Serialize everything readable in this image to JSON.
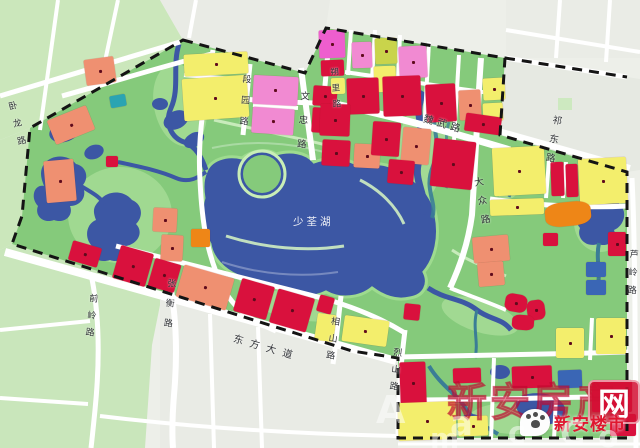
{
  "map": {
    "lake": {
      "name": "少荃湖"
    },
    "palette": {
      "red": "#d9113d",
      "salmon": "#ef9071",
      "yellow": "#f3ee6c",
      "pink": "#f18ad2",
      "magenta": "#ee5ece",
      "orange": "#ee8617",
      "olive": "#c9d44b",
      "teal": "#2aa4b2",
      "blue": "#3a66b5",
      "park_green": "#85ca7b",
      "marsh_green": "#a6dc97",
      "water": "#3c57a4",
      "stream_teal": "#3a7d96",
      "outside_green": "#cbe7bb",
      "city_gray": "#e9ebe5",
      "boundary": "#141414"
    },
    "road_labels": [
      {
        "id": "wolong",
        "name": "卧龙路",
        "x": 7,
        "y": 100,
        "rot": -14,
        "vertical": true,
        "s": 9,
        "gap": 5
      },
      {
        "id": "qianling",
        "name": "前岭路",
        "x": 90,
        "y": 291,
        "rot": 6,
        "vertical": true,
        "s": 9,
        "gap": 4
      },
      {
        "id": "zhangheng",
        "name": "张衡路",
        "x": 168,
        "y": 276,
        "rot": 5,
        "vertical": true,
        "s": 9,
        "gap": 7
      },
      {
        "id": "dongfangdadao",
        "name": "东方大道",
        "x": 236,
        "y": 330,
        "rot": 16,
        "vertical": false,
        "s": 10,
        "gap": 7
      },
      {
        "id": "duanyuan",
        "name": "段园路",
        "x": 243,
        "y": 72,
        "rot": 4,
        "vertical": true,
        "s": 9,
        "gap": 8
      },
      {
        "id": "wenzhong",
        "name": "文忠路",
        "x": 301,
        "y": 88,
        "rot": 4,
        "vertical": true,
        "s": 9.5,
        "gap": 10
      },
      {
        "id": "shuoli",
        "name": "朔里路",
        "x": 330,
        "y": 66,
        "rot": -4,
        "vertical": true,
        "s": 8.5,
        "gap": 4
      },
      {
        "id": "weiwu",
        "name": "魏武路",
        "x": 426,
        "y": 110,
        "rot": 16,
        "vertical": false,
        "s": 10,
        "gap": 4
      },
      {
        "id": "dazhong",
        "name": "大众路",
        "x": 473,
        "y": 175,
        "rot": -10,
        "vertical": true,
        "s": 9.5,
        "gap": 5
      },
      {
        "id": "qidong",
        "name": "祁东路",
        "x": 554,
        "y": 112,
        "rot": 10,
        "vertical": true,
        "s": 9.5,
        "gap": 5
      },
      {
        "id": "xiangshan",
        "name": "相山路",
        "x": 332,
        "y": 314,
        "rot": 8,
        "vertical": true,
        "s": 9,
        "gap": 4
      },
      {
        "id": "lieshan",
        "name": "烈山路",
        "x": 394,
        "y": 345,
        "rot": 6,
        "vertical": true,
        "s": 9,
        "gap": 4
      },
      {
        "id": "luling",
        "name": "芦岭路",
        "x": 630,
        "y": 247,
        "rot": 3,
        "vertical": true,
        "s": 9,
        "gap": 5
      }
    ],
    "parcels": [
      {
        "x": 184,
        "y": 53,
        "w": 64,
        "h": 22,
        "c": "yellow",
        "r": -3,
        "d": 1
      },
      {
        "x": 183,
        "y": 77,
        "w": 65,
        "h": 42,
        "c": "yellow",
        "r": -4,
        "d": 1
      },
      {
        "x": 253,
        "y": 76,
        "w": 45,
        "h": 29,
        "c": "pink",
        "r": 3,
        "d": 1
      },
      {
        "x": 252,
        "y": 108,
        "w": 42,
        "h": 26,
        "c": "pink",
        "r": 4,
        "d": 1
      },
      {
        "x": 313,
        "y": 86,
        "w": 24,
        "h": 20,
        "c": "red",
        "r": 4,
        "d": 1
      },
      {
        "x": 312,
        "y": 108,
        "w": 26,
        "h": 25,
        "c": "red",
        "r": 4,
        "d": 1
      },
      {
        "x": 319,
        "y": 30,
        "w": 26,
        "h": 28,
        "c": "magenta",
        "r": -2,
        "d": 1
      },
      {
        "x": 321,
        "y": 60,
        "w": 23,
        "h": 16,
        "c": "red",
        "r": -2,
        "d": 0
      },
      {
        "x": 352,
        "y": 42,
        "w": 20,
        "h": 26,
        "c": "pink",
        "r": -2,
        "d": 1
      },
      {
        "x": 375,
        "y": 38,
        "w": 22,
        "h": 26,
        "c": "olive",
        "r": -2,
        "d": 1
      },
      {
        "x": 374,
        "y": 66,
        "w": 22,
        "h": 26,
        "c": "yellow",
        "r": -2,
        "d": 1
      },
      {
        "x": 399,
        "y": 46,
        "w": 28,
        "h": 32,
        "c": "pink",
        "r": -3,
        "d": 1
      },
      {
        "x": 331,
        "y": 78,
        "w": 14,
        "h": 16,
        "c": "yellow",
        "r": -2,
        "d": 0
      },
      {
        "x": 347,
        "y": 78,
        "w": 32,
        "h": 36,
        "c": "red",
        "r": -2,
        "d": 1
      },
      {
        "x": 383,
        "y": 76,
        "w": 38,
        "h": 40,
        "c": "red",
        "r": -2,
        "d": 1
      },
      {
        "x": 426,
        "y": 84,
        "w": 30,
        "h": 38,
        "c": "red",
        "r": -3,
        "d": 1
      },
      {
        "x": 459,
        "y": 90,
        "w": 22,
        "h": 30,
        "c": "salmon",
        "r": -3,
        "d": 1
      },
      {
        "x": 483,
        "y": 78,
        "w": 22,
        "h": 22,
        "c": "yellow",
        "r": -3,
        "d": 1
      },
      {
        "x": 483,
        "y": 103,
        "w": 20,
        "h": 18,
        "c": "yellow",
        "r": -3,
        "d": 0
      },
      {
        "x": 465,
        "y": 115,
        "w": 36,
        "h": 18,
        "c": "red",
        "r": 8,
        "d": 1
      },
      {
        "x": 320,
        "y": 104,
        "w": 30,
        "h": 32,
        "c": "red",
        "r": 2,
        "d": 1
      },
      {
        "x": 322,
        "y": 140,
        "w": 28,
        "h": 26,
        "c": "red",
        "r": 3,
        "d": 1
      },
      {
        "x": 354,
        "y": 144,
        "w": 26,
        "h": 24,
        "c": "salmon",
        "r": 3,
        "d": 1
      },
      {
        "x": 372,
        "y": 122,
        "w": 28,
        "h": 34,
        "c": "red",
        "r": 4,
        "d": 1
      },
      {
        "x": 402,
        "y": 128,
        "w": 28,
        "h": 36,
        "c": "salmon",
        "r": 5,
        "d": 1
      },
      {
        "x": 388,
        "y": 160,
        "w": 26,
        "h": 24,
        "c": "red",
        "r": 5,
        "d": 1
      },
      {
        "x": 432,
        "y": 140,
        "w": 42,
        "h": 48,
        "c": "red",
        "r": 6,
        "d": 1
      },
      {
        "x": 493,
        "y": 147,
        "w": 52,
        "h": 48,
        "c": "yellow",
        "r": -3,
        "d": 1
      },
      {
        "x": 551,
        "y": 162,
        "w": 13,
        "h": 34,
        "c": "red",
        "r": -2,
        "d": 0
      },
      {
        "x": 566,
        "y": 164,
        "w": 12,
        "h": 33,
        "c": "red",
        "r": -2,
        "d": 0
      },
      {
        "x": 579,
        "y": 158,
        "w": 48,
        "h": 46,
        "c": "yellow",
        "r": -3,
        "d": 1
      },
      {
        "x": 490,
        "y": 199,
        "w": 54,
        "h": 16,
        "c": "yellow",
        "r": -2,
        "d": 1
      },
      {
        "x": 545,
        "y": 202,
        "w": 46,
        "h": 24,
        "c": "orange",
        "r": -6,
        "d": 0,
        "rr": 1
      },
      {
        "x": 608,
        "y": 232,
        "w": 18,
        "h": 24,
        "c": "red",
        "r": 0,
        "d": 1
      },
      {
        "x": 586,
        "y": 262,
        "w": 20,
        "h": 15,
        "c": "blue",
        "r": 0,
        "d": 0
      },
      {
        "x": 586,
        "y": 280,
        "w": 20,
        "h": 15,
        "c": "blue",
        "r": 0,
        "d": 0
      },
      {
        "x": 596,
        "y": 318,
        "w": 30,
        "h": 36,
        "c": "yellow",
        "r": 0,
        "d": 1
      },
      {
        "x": 556,
        "y": 328,
        "w": 28,
        "h": 30,
        "c": "yellow",
        "r": 0,
        "d": 1
      },
      {
        "x": 85,
        "y": 58,
        "w": 30,
        "h": 26,
        "c": "salmon",
        "r": -8,
        "d": 1
      },
      {
        "x": 50,
        "y": 112,
        "w": 42,
        "h": 26,
        "c": "salmon",
        "r": -22,
        "d": 1
      },
      {
        "x": 45,
        "y": 160,
        "w": 30,
        "h": 42,
        "c": "salmon",
        "r": -5,
        "d": 1
      },
      {
        "x": 110,
        "y": 95,
        "w": 16,
        "h": 12,
        "c": "teal",
        "r": -10,
        "d": 0
      },
      {
        "x": 106,
        "y": 156,
        "w": 12,
        "h": 11,
        "c": "red",
        "r": 0,
        "d": 0
      },
      {
        "x": 153,
        "y": 208,
        "w": 24,
        "h": 24,
        "c": "salmon",
        "r": 3,
        "d": 1
      },
      {
        "x": 161,
        "y": 235,
        "w": 22,
        "h": 26,
        "c": "salmon",
        "r": 3,
        "d": 1
      },
      {
        "x": 191,
        "y": 229,
        "w": 19,
        "h": 18,
        "c": "orange",
        "r": 0,
        "d": 0
      },
      {
        "x": 473,
        "y": 236,
        "w": 36,
        "h": 26,
        "c": "salmon",
        "r": -5,
        "d": 1
      },
      {
        "x": 478,
        "y": 262,
        "w": 26,
        "h": 24,
        "c": "salmon",
        "r": -5,
        "d": 1
      },
      {
        "x": 505,
        "y": 294,
        "w": 22,
        "h": 18,
        "c": "red",
        "r": 10,
        "d": 1,
        "rr": 1
      },
      {
        "x": 527,
        "y": 300,
        "w": 18,
        "h": 20,
        "c": "red",
        "r": -8,
        "d": 1,
        "rr": 1
      },
      {
        "x": 512,
        "y": 315,
        "w": 22,
        "h": 15,
        "c": "red",
        "r": 4,
        "d": 0,
        "rr": 1
      },
      {
        "x": 543,
        "y": 233,
        "w": 15,
        "h": 13,
        "c": "red",
        "r": 0,
        "d": 0
      },
      {
        "x": 70,
        "y": 244,
        "w": 30,
        "h": 20,
        "c": "red",
        "r": 16,
        "d": 1
      },
      {
        "x": 116,
        "y": 249,
        "w": 34,
        "h": 34,
        "c": "red",
        "r": 16,
        "d": 1
      },
      {
        "x": 151,
        "y": 261,
        "w": 27,
        "h": 29,
        "c": "red",
        "r": 16,
        "d": 1
      },
      {
        "x": 179,
        "y": 271,
        "w": 52,
        "h": 33,
        "c": "salmon",
        "r": 16,
        "d": 1
      },
      {
        "x": 237,
        "y": 282,
        "w": 34,
        "h": 34,
        "c": "red",
        "r": 16,
        "d": 1
      },
      {
        "x": 273,
        "y": 293,
        "w": 38,
        "h": 35,
        "c": "red",
        "r": 16,
        "d": 1
      },
      {
        "x": 318,
        "y": 296,
        "w": 15,
        "h": 17,
        "c": "red",
        "r": 16,
        "d": 0
      },
      {
        "x": 316,
        "y": 314,
        "w": 19,
        "h": 27,
        "c": "yellow",
        "r": 8,
        "d": 0
      },
      {
        "x": 343,
        "y": 318,
        "w": 45,
        "h": 26,
        "c": "yellow",
        "r": 8,
        "d": 1
      },
      {
        "x": 404,
        "y": 304,
        "w": 16,
        "h": 16,
        "c": "red",
        "r": 6,
        "d": 0
      },
      {
        "x": 400,
        "y": 362,
        "w": 26,
        "h": 42,
        "c": "red",
        "r": -2,
        "d": 1
      },
      {
        "x": 453,
        "y": 368,
        "w": 28,
        "h": 15,
        "c": "red",
        "r": -2,
        "d": 0
      },
      {
        "x": 512,
        "y": 366,
        "w": 40,
        "h": 22,
        "c": "red",
        "r": -2,
        "d": 1
      },
      {
        "x": 558,
        "y": 370,
        "w": 24,
        "h": 18,
        "c": "blue",
        "r": -2,
        "d": 0
      },
      {
        "x": 592,
        "y": 380,
        "w": 40,
        "h": 32,
        "c": "red",
        "r": 0,
        "d": 1
      },
      {
        "x": 398,
        "y": 402,
        "w": 58,
        "h": 38,
        "c": "yellow",
        "r": -2,
        "d": 1
      },
      {
        "x": 458,
        "y": 416,
        "w": 30,
        "h": 20,
        "c": "yellow",
        "r": -2,
        "d": 1
      },
      {
        "x": 610,
        "y": 414,
        "w": 26,
        "h": 22,
        "c": "red",
        "r": 0,
        "d": 0
      }
    ]
  },
  "watermark": {
    "site_prefix": "新安房产",
    "site_box": "网",
    "logo_text": "新安楼市",
    "letters": [
      {
        "ch": "A",
        "x": 376,
        "y": 388,
        "s": 38
      },
      {
        "ch": "a",
        "x": 450,
        "y": 404,
        "s": 34
      },
      {
        "ch": "c",
        "x": 508,
        "y": 416,
        "s": 30
      },
      {
        "ch": "C",
        "x": 560,
        "y": 414,
        "s": 34
      },
      {
        "ch": "o",
        "x": 598,
        "y": 420,
        "s": 30
      },
      {
        "ch": "m",
        "x": 430,
        "y": 422,
        "s": 28
      }
    ]
  }
}
